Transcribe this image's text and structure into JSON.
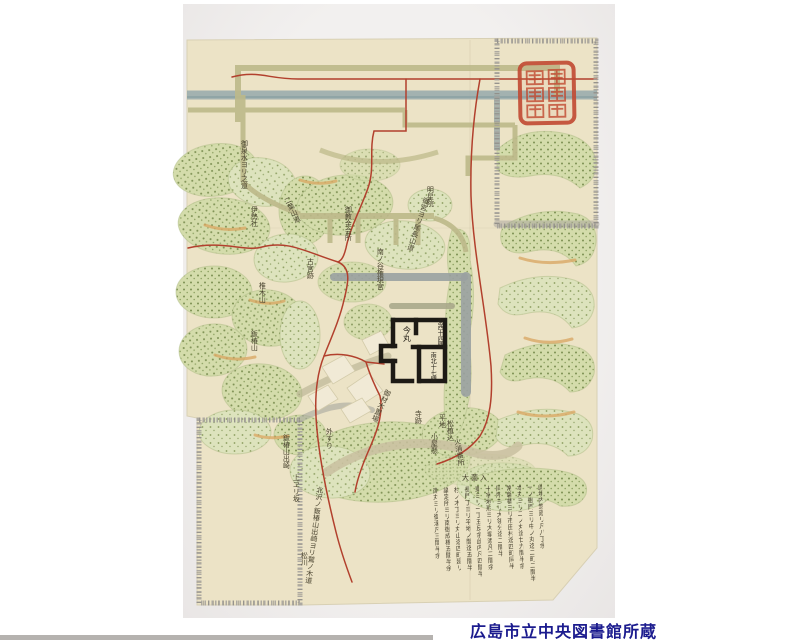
{
  "photo": {
    "description": "photograph of an Edo-period hand-drawn Japanese map on cream paper",
    "caption": {
      "text": "広島市立中央図書館所蔵",
      "color": "#1b1b8e"
    }
  },
  "map": {
    "type": "historical-japanese-map",
    "seal": {
      "name": "red-square-collection-seal",
      "color": "#c14a32"
    },
    "colors": {
      "paper": "#ece3c6",
      "mountain_green": "#d4dcab",
      "mountain_dots": "#7e9154",
      "route_red": "#b2402d",
      "river_gray_blue": "#96a9ab",
      "road_olive": "#bdb98a",
      "castle_black": "#1d1a15",
      "caption_blue": "#1b1b8e"
    },
    "labels": [
      {
        "text": "御泉水ヨリ之道"
      },
      {
        "text": "伊勢社"
      },
      {
        "text": "椎木山"
      },
      {
        "text": "鈑椿山"
      },
      {
        "text": "鈑椿山出崎"
      },
      {
        "text": "上ヱリ坂"
      },
      {
        "text": "北沢ノ鈑椿山出崎ヨリ鷲ノ木道"
      },
      {
        "text": "御教金会所"
      },
      {
        "text": "古宮跡"
      },
      {
        "text": "南ノ谷権現宮"
      },
      {
        "text": "御宮ヨリ尾長山道"
      },
      {
        "text": "外すり"
      },
      {
        "text": "御材木置場"
      },
      {
        "text": "寺跡"
      },
      {
        "text": "平地"
      },
      {
        "text": "松植込"
      },
      {
        "text": "小屋懸"
      },
      {
        "text": "火消番所"
      },
      {
        "text": "松川"
      },
      {
        "text": "明星院"
      },
      {
        "text": "二葉山道"
      }
    ],
    "castle": {
      "labels": [
        {
          "text": "今丸"
        },
        {
          "text": "東西十四間"
        },
        {
          "text": "南北十七間"
        }
      ]
    },
    "garden_label": {
      "text": "大薗入"
    },
    "notes": {
      "columns": [
        "此境内惣廻リ凡八丁余",
        "一ノ御門ヨリ中ノ丸迄二町二間半",
        "本丸ヨリ二ノ丸迄廿九間半余",
        "常磐橋ヨリ市田村迄四町同半",
        "同所ヨリ大領分迄二間半",
        "十字地形ヨリ大塀添凡二間余",
        "東ヨリ一丁五反余此内凡四間半",
        "長門丁ヨリ平地ノ間迄五間半",
        "杉ノ木丁ヨリ丸山迄四町廻リ",
        "議定所ヨリ南御成橋五間半余",
        "南丸ヨリ御濠凡三間半余"
      ]
    }
  }
}
